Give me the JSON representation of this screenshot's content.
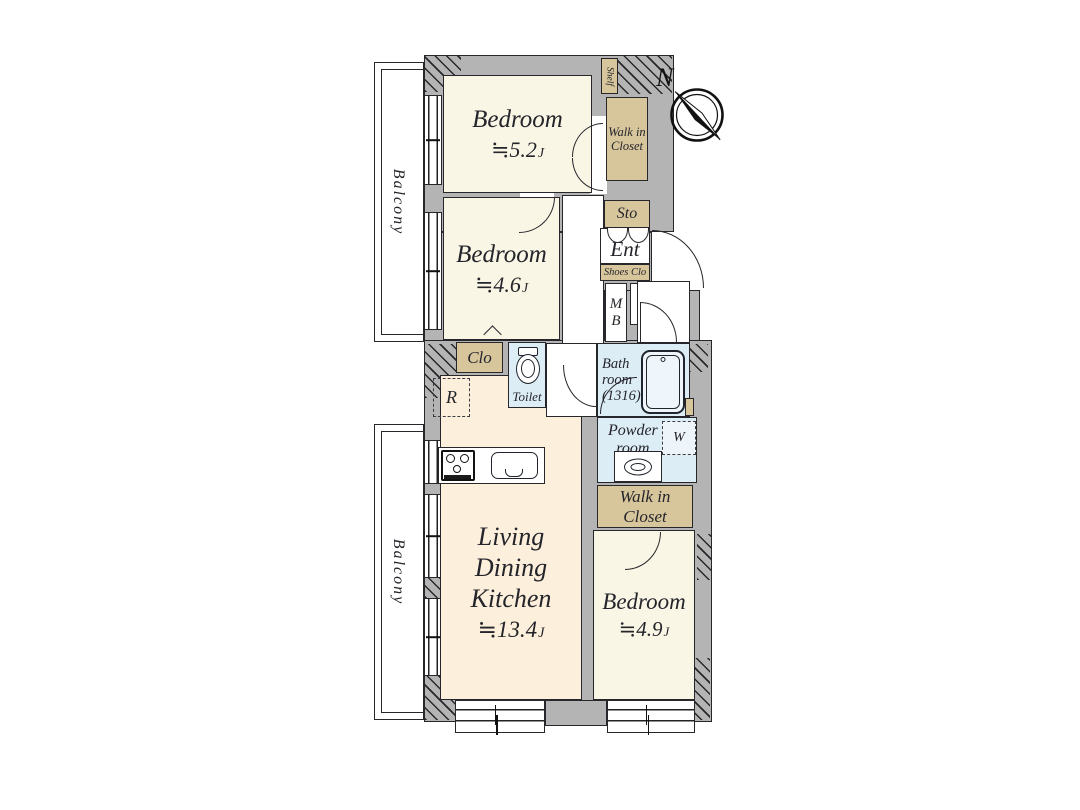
{
  "colors": {
    "wall": "#b4b4b4",
    "outline": "#26262b",
    "bedroom": "#faf6e5",
    "ldk": "#fcefdb",
    "closet": "#d7c69c",
    "wet": "#ddedf6",
    "text": "#24242b"
  },
  "compass": {
    "north_label": "N"
  },
  "balcony_top": {
    "label": "Balcony"
  },
  "balcony_bottom": {
    "label": "Balcony"
  },
  "rooms": {
    "bedroom_top": {
      "name": "Bedroom",
      "size": "≒5.2",
      "unit": "J"
    },
    "bedroom_mid": {
      "name": "Bedroom",
      "size": "≒4.6",
      "unit": "J"
    },
    "bedroom_right": {
      "name": "Bedroom",
      "size": "≒4.9",
      "unit": "J"
    },
    "ldk": {
      "name": "Living Dining\nKitchen",
      "size": "≒13.4",
      "unit": "J"
    },
    "walkin_closet_top": {
      "label": "Walk in\nCloset"
    },
    "walkin_closet_bottom": {
      "label": "Walk in\nCloset"
    },
    "bath": {
      "label": "Bath\nroom\n(1316)"
    },
    "powder": {
      "label": "Powder\nroom"
    },
    "toilet": {
      "label": "Toilet"
    },
    "entrance": {
      "label": "Ent"
    },
    "storage": {
      "label": "Sto"
    },
    "shoes_closet": {
      "label": "Shoes Clo"
    },
    "meter_box": {
      "label": "M\nB"
    },
    "closet": {
      "label": "Clo"
    },
    "shelf": {
      "label": "Shelf"
    },
    "refrigerator": {
      "label": "R"
    },
    "washer": {
      "label": "W"
    }
  }
}
